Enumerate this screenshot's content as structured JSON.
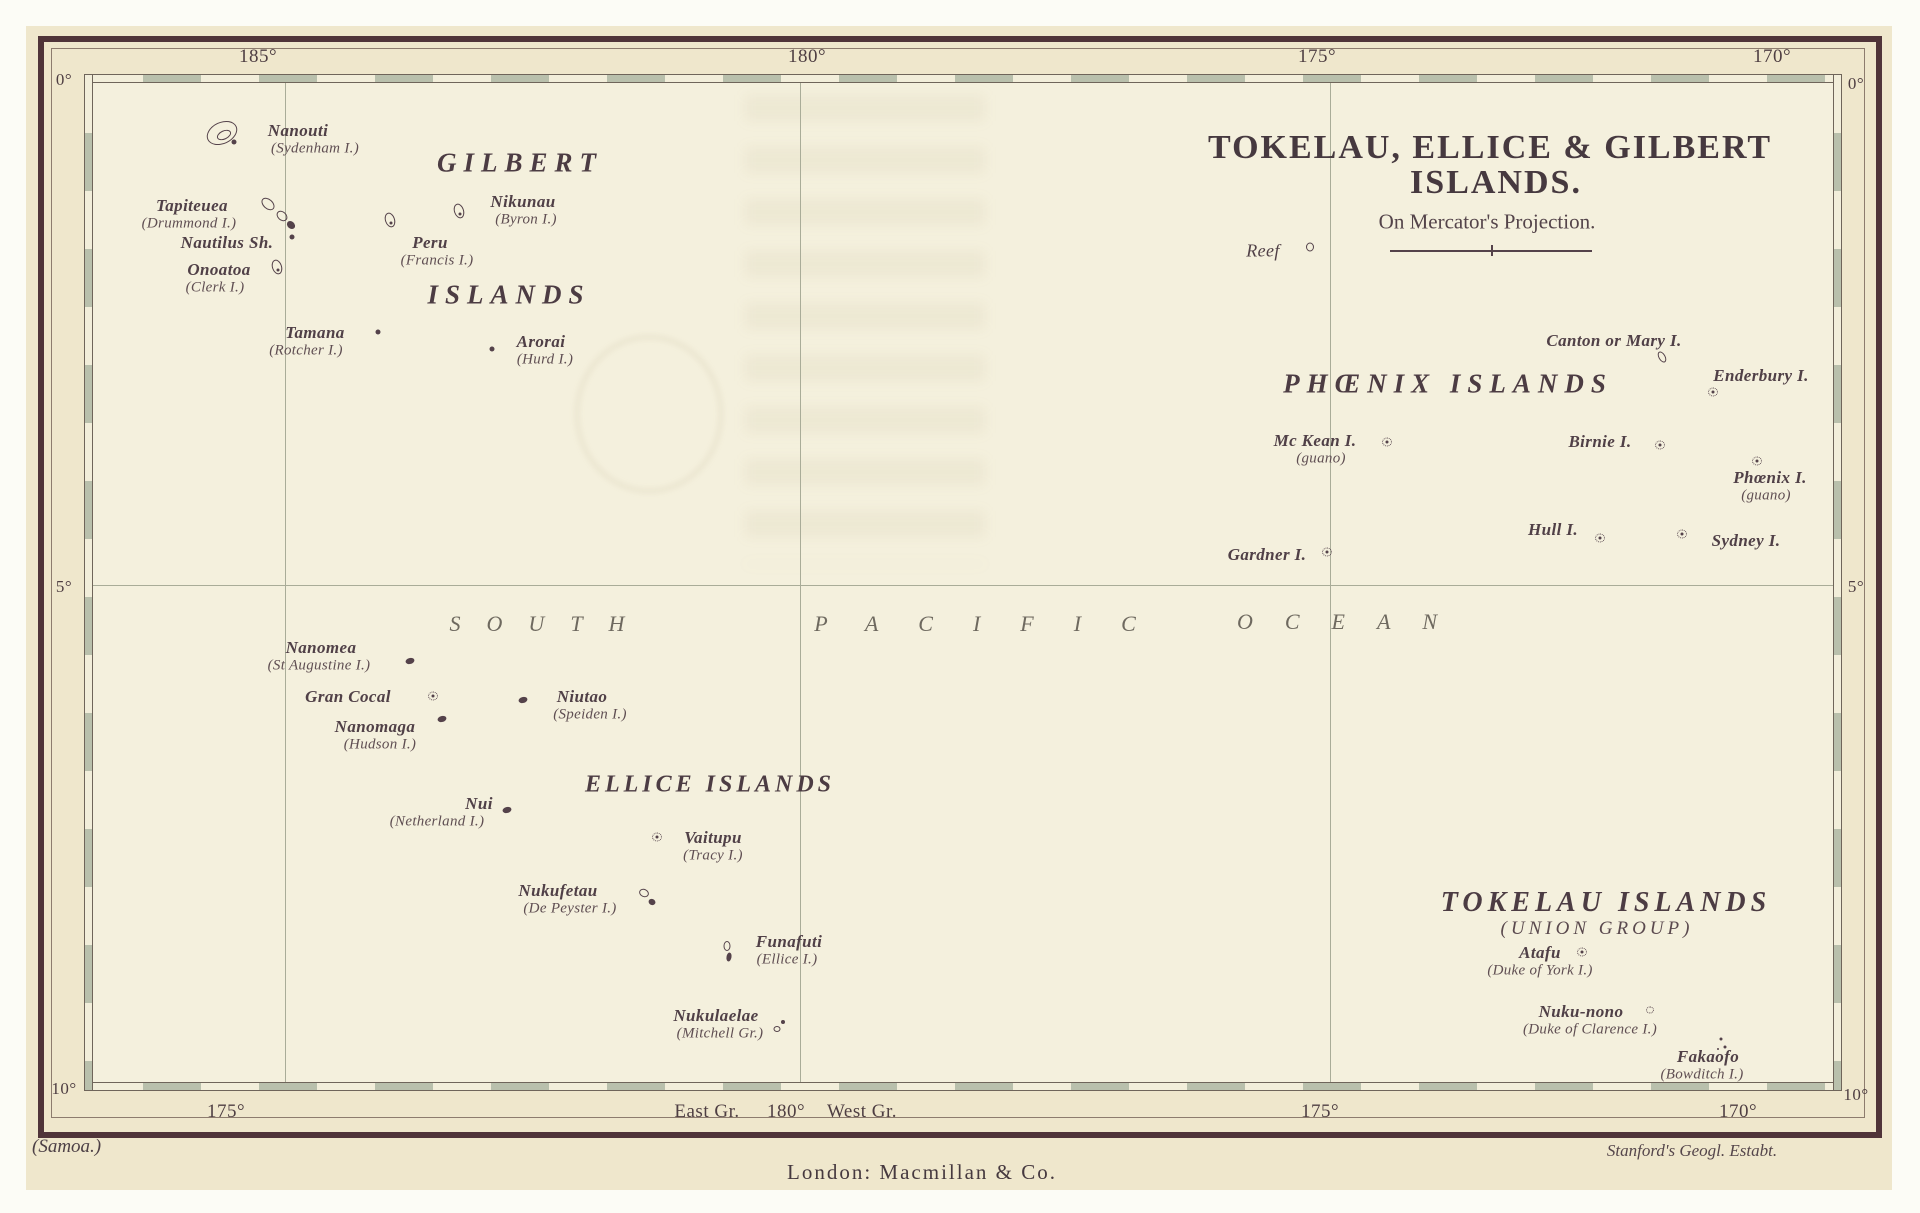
{
  "map": {
    "title_line1": "TOKELAU, ELLICE & GILBERT",
    "title_line2": "ISLANDS.",
    "subtitle": "On Mercator's Projection.",
    "footer": {
      "left": "(Samoa.)",
      "center": "London: Macmillan & Co.",
      "right": "Stanford's Geogl. Estabt."
    }
  },
  "colors": {
    "paper": "#f4f0dd",
    "plate_band": "#efe7cc",
    "ink": "#504047",
    "border": "#503439",
    "ladder_fill": "#b9c0ac",
    "gridline": "#a9ac98"
  },
  "graticule": {
    "top_labels": [
      {
        "text": "185°",
        "x": 258
      },
      {
        "text": "180°",
        "x": 807
      },
      {
        "text": "175°",
        "x": 1317
      },
      {
        "text": "170°",
        "x": 1772
      }
    ],
    "bottom_labels": [
      {
        "text": "175°",
        "x": 226
      },
      {
        "text": "East Gr.",
        "x": 707
      },
      {
        "text": "180°",
        "x": 786
      },
      {
        "text": "West Gr.",
        "x": 862
      },
      {
        "text": "175°",
        "x": 1320
      },
      {
        "text": "170°",
        "x": 1738
      }
    ],
    "left_labels": [
      {
        "text": "0°",
        "y": 80
      },
      {
        "text": "5°",
        "y": 587
      },
      {
        "text": "10°",
        "y": 1089
      }
    ],
    "right_labels": [
      {
        "text": "0°",
        "y": 84
      },
      {
        "text": "5°",
        "y": 587
      },
      {
        "text": "10°",
        "y": 1095
      }
    ],
    "meridians_x": [
      285,
      800,
      1330
    ],
    "parallels_y": [
      585
    ]
  },
  "ocean_words": [
    {
      "text": "SOUTH",
      "x": 550,
      "y": 624,
      "ls": 26
    },
    {
      "text": "PACIFIC",
      "x": 995,
      "y": 624,
      "ls": 40
    },
    {
      "text": "OCEAN",
      "x": 1353,
      "y": 622,
      "ls": 32
    }
  ],
  "group_labels": [
    {
      "text": "GILBERT",
      "x": 520,
      "y": 163,
      "fs": 27,
      "ls": 7
    },
    {
      "text": "ISLANDS",
      "x": 509,
      "y": 295,
      "fs": 27,
      "ls": 7
    },
    {
      "text": "PHŒNIX ISLANDS",
      "x": 1448,
      "y": 384,
      "fs": 27,
      "ls": 7
    },
    {
      "text": "ELLICE ISLANDS",
      "x": 710,
      "y": 785,
      "fs": 24,
      "ls": 4
    },
    {
      "text": "TOKELAU ISLANDS",
      "x": 1606,
      "y": 903,
      "fs": 28,
      "ls": 5
    },
    {
      "text": "(UNION GROUP)",
      "x": 1597,
      "y": 929,
      "fs": 19,
      "ls": 4,
      "sub": true
    }
  ],
  "islands": [
    {
      "name": "Nanouti",
      "alt": "(Sydenham I.)",
      "x": 298,
      "y": 131,
      "adx": 17,
      "sym": "atoll",
      "sx": 222,
      "sy": 133
    },
    {
      "name": "Tapiteuea",
      "alt": "(Drummond I.)",
      "x": 192,
      "y": 206,
      "adx": -3,
      "sym": "chain",
      "sx": 278,
      "sy": 214
    },
    {
      "name": "Nautilus Sh.",
      "x": 227,
      "y": 243,
      "sym": "dot",
      "sx": 292,
      "sy": 237
    },
    {
      "name": "Onoatoa",
      "alt": "(Clerk I.)",
      "x": 219,
      "y": 270,
      "adx": -4,
      "sym": "islet",
      "sx": 277,
      "sy": 267
    },
    {
      "name": "Peru",
      "alt": "(Francis I.)",
      "x": 430,
      "y": 243,
      "adx": 7,
      "sym": "islet",
      "sx": 390,
      "sy": 220
    },
    {
      "name": "Nikunau",
      "alt": "(Byron I.)",
      "x": 523,
      "y": 202,
      "adx": 3,
      "sym": "islet",
      "sx": 459,
      "sy": 211
    },
    {
      "name": "Tamana",
      "alt": "(Rotcher I.)",
      "x": 315,
      "y": 333,
      "adx": -9,
      "sym": "dot",
      "sx": 378,
      "sy": 332
    },
    {
      "name": "Arorai",
      "alt": "(Hurd I.)",
      "x": 541,
      "y": 342,
      "adx": 4,
      "sym": "dot",
      "sx": 492,
      "sy": 349
    },
    {
      "name": "Reef",
      "x": 1263,
      "y": 251,
      "light": true,
      "sym": "ringsm",
      "sx": 1310,
      "sy": 247
    },
    {
      "name": "Canton or Mary I.",
      "x": 1614,
      "y": 341,
      "sym": "isletsm",
      "sx": 1662,
      "sy": 357
    },
    {
      "name": "Enderbury I.",
      "x": 1761,
      "y": 376,
      "sym": "dotted",
      "sx": 1713,
      "sy": 392
    },
    {
      "name": "Mc Kean I.",
      "alt": "(guano)",
      "x": 1315,
      "y": 441,
      "adx": 6,
      "sym": "dotted",
      "sx": 1387,
      "sy": 442
    },
    {
      "name": "Birnie I.",
      "x": 1600,
      "y": 442,
      "sym": "dotted",
      "sx": 1660,
      "sy": 445
    },
    {
      "name": "Phœnix I.",
      "alt": "(guano)",
      "x": 1770,
      "y": 478,
      "adx": -4,
      "sym": "dotted",
      "sx": 1757,
      "sy": 461
    },
    {
      "name": "Hull I.",
      "x": 1553,
      "y": 530,
      "sym": "dotted",
      "sx": 1600,
      "sy": 538
    },
    {
      "name": "Sydney I.",
      "x": 1746,
      "y": 541,
      "sym": "dotted",
      "sx": 1682,
      "sy": 534
    },
    {
      "name": "Gardner I.",
      "x": 1267,
      "y": 555,
      "sym": "dotted",
      "sx": 1327,
      "sy": 552
    },
    {
      "name": "Nanomea",
      "alt": "(St Augustine I.)",
      "x": 321,
      "y": 648,
      "adx": -2,
      "sym": "blob",
      "sx": 410,
      "sy": 661
    },
    {
      "name": "Gran Cocal",
      "x": 348,
      "y": 697,
      "sym": "dotted",
      "sx": 433,
      "sy": 696
    },
    {
      "name": "Nanomaga",
      "alt": "(Hudson I.)",
      "x": 375,
      "y": 727,
      "adx": 5,
      "sym": "blob",
      "sx": 442,
      "sy": 719
    },
    {
      "name": "Niutao",
      "alt": "(Speiden I.)",
      "x": 582,
      "y": 697,
      "adx": 8,
      "sym": "blob",
      "sx": 523,
      "sy": 700
    },
    {
      "name": "Nui",
      "alt": "(Netherland I.)",
      "x": 479,
      "y": 804,
      "adx": -42,
      "sym": "blob",
      "sx": 507,
      "sy": 810
    },
    {
      "name": "Vaitupu",
      "alt": "(Tracy I.)",
      "x": 713,
      "y": 838,
      "adx": 0,
      "sym": "dotted",
      "sx": 657,
      "sy": 837
    },
    {
      "name": "Nukufetau",
      "alt": "(De Peyster I.)",
      "x": 558,
      "y": 891,
      "adx": 12,
      "sym": "chainsm",
      "sx": 647,
      "sy": 897
    },
    {
      "name": "Funafuti",
      "alt": "(Ellice I.)",
      "x": 789,
      "y": 942,
      "adx": -2,
      "sym": "chainv",
      "sx": 727,
      "sy": 952
    },
    {
      "name": "Nukulaelae",
      "alt": "(Mitchell Gr.)",
      "x": 716,
      "y": 1016,
      "adx": 4,
      "sym": "chainsm2",
      "sx": 779,
      "sy": 1027
    },
    {
      "name": "Atafu",
      "alt": "(Duke of York I.)",
      "x": 1540,
      "y": 953,
      "adx": 0,
      "sym": "dotted",
      "sx": 1582,
      "sy": 952
    },
    {
      "name": "Nuku-nono",
      "alt": "(Duke of Clarence I.)",
      "x": 1581,
      "y": 1012,
      "adx": 9,
      "sym": "opendots",
      "sx": 1650,
      "sy": 1010
    },
    {
      "name": "Fakaofo",
      "alt": "(Bowditch I.)",
      "x": 1708,
      "y": 1057,
      "adx": -6,
      "sym": "dots3",
      "sx": 1721,
      "sy": 1043
    }
  ],
  "scale_bar": {
    "x1": 1390,
    "x2": 1592,
    "y": 250
  }
}
